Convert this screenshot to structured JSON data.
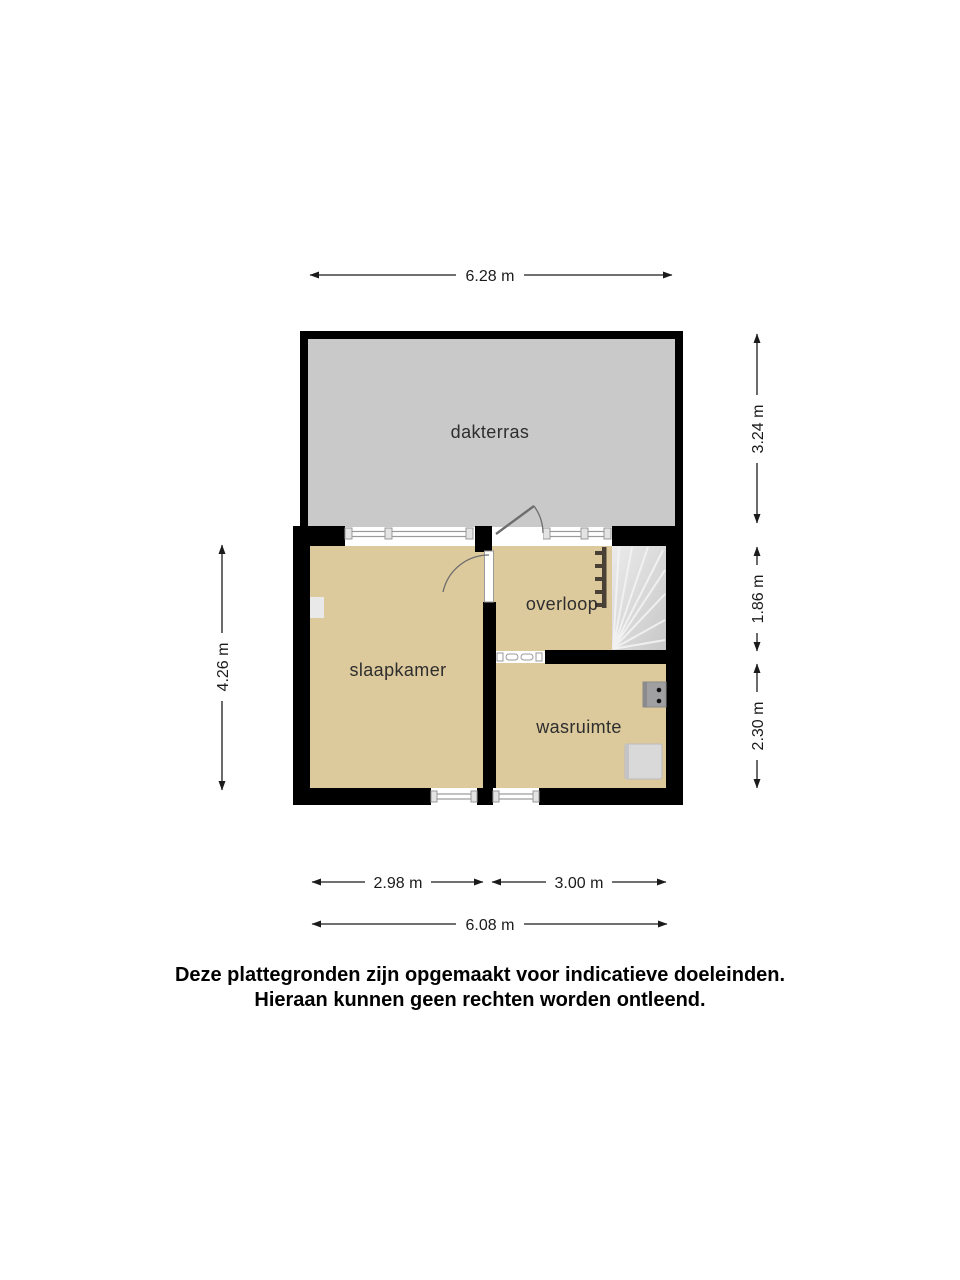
{
  "plan": {
    "rooms": {
      "terrace": {
        "label": "dakterras"
      },
      "bedroom": {
        "label": "slaapkamer"
      },
      "landing": {
        "label": "overloop"
      },
      "laundry": {
        "label": "wasruimte"
      }
    },
    "dimensions": {
      "top_width": "6.28 m",
      "terrace_height": "3.24 m",
      "landing_height": "1.86 m",
      "laundry_height": "2.30 m",
      "floor_height": "4.26 m",
      "bottom_left_width": "2.98 m",
      "bottom_right_width": "3.00 m",
      "bottom_total_width": "6.08 m"
    },
    "colors": {
      "room_fill": "#dcc99c",
      "terrace_fill": "#c9c9c9",
      "wall": "#000000",
      "stairs_fill_light": "#ebebeb",
      "stairs_fill_dark": "#c8c8c8",
      "stair_step_line": "#f3f3f3",
      "railing": "#4a4136",
      "window_frame": "#9a9a9a",
      "door_stroke": "#6e6e6e",
      "dimension_line": "#1b1b1b"
    }
  },
  "disclaimer": {
    "line1": "Deze plattegronden zijn opgemaakt voor indicatieve doeleinden.",
    "line2": "Hieraan kunnen geen rechten worden ontleend."
  }
}
